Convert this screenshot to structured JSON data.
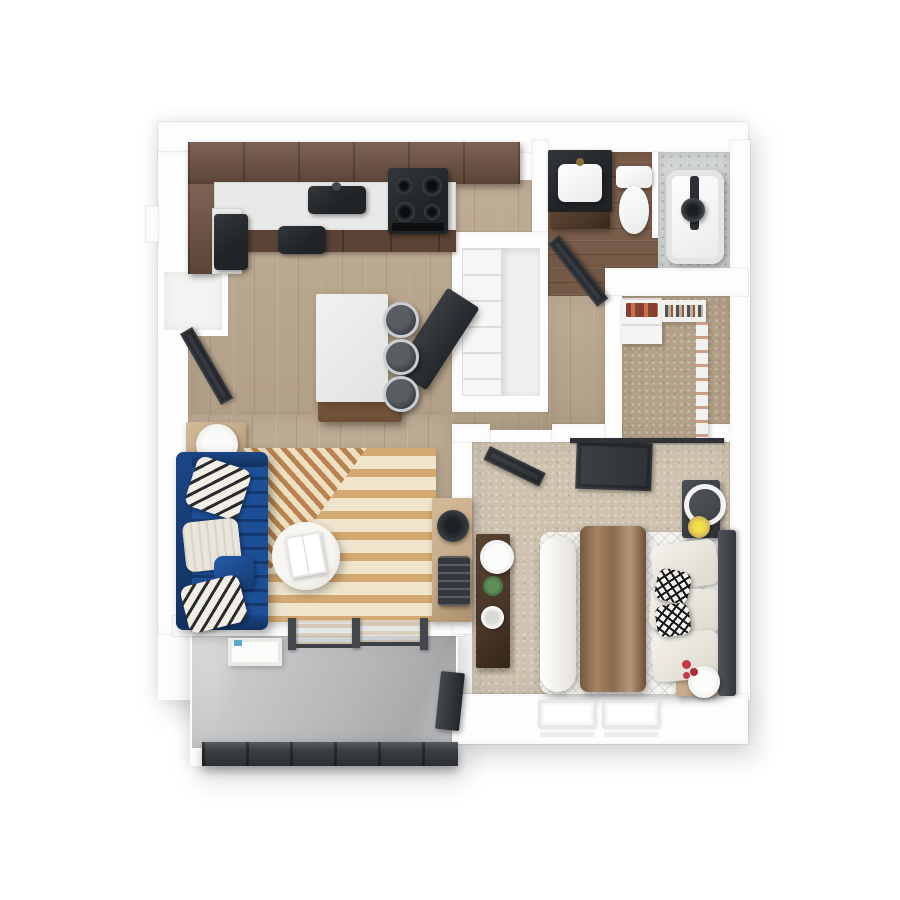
{
  "meta": {
    "title": "3D top-down floor plan render — one-bedroom, one-bath apartment with balcony",
    "view": "top-down 3D dollhouse render",
    "visible_text": ""
  },
  "palette": {
    "wall": "#fdfdfd",
    "wallEdge": "#d9d9d9",
    "woodFloor": "#bca88f",
    "bathFloor": "#7a5d4a",
    "carpet": "#cfc3b0",
    "carpetDark": "#b4a288",
    "concrete": "#b7b9bb",
    "cabinet": "#6f5242",
    "cabinetDark": "#5b4335",
    "counter": "#e9e9e7",
    "black": "#212427",
    "steel": "#c9ced3",
    "navy": "#1d4f96",
    "navyDark": "#143a70",
    "door": "#3c4147",
    "rugBase": "#efe5cd",
    "rugTan": "#d3a871",
    "rugRust": "#b9834d",
    "throwBrown": "#8d7157",
    "bedWhite": "#f4f3ef",
    "woodWarm": "#c5ab8a",
    "walnut": "#4a3628",
    "tile": "#d3d6d4",
    "green": "#3e6b3f",
    "red": "#c43b46",
    "gold": "#d1b05a"
  },
  "rooms": {
    "kitchen": {
      "label": "Kitchen",
      "floor": "hardwood"
    },
    "entry": {
      "label": "Entry",
      "floor": "hardwood"
    },
    "living": {
      "label": "Living Room",
      "floor": "hardwood"
    },
    "bathroom": {
      "label": "Bathroom",
      "floor": "dark hardwood"
    },
    "utility": {
      "label": "Utility Closet",
      "floor": "white"
    },
    "closet": {
      "label": "Walk-in Closet",
      "floor": "carpet"
    },
    "bedroom": {
      "label": "Bedroom",
      "floor": "carpet"
    },
    "balcony": {
      "label": "Balcony",
      "floor": "concrete"
    }
  },
  "furniture": {
    "kitchen": [
      "upper cabinets",
      "counter with sink",
      "range with 4 burners",
      "lower cabinets",
      "refrigerator",
      "tall pantry cabinet",
      "island",
      "3 bar stools"
    ],
    "entry": [
      "coat niche",
      "entry door",
      "side table with lamp"
    ],
    "living": [
      "navy channel-tufted sofa",
      "chevron pillows",
      "knit pillow",
      "striped rug",
      "round coffee table with book",
      "navy accent chair",
      "wood console",
      "fan",
      "slat basket"
    ],
    "bathroom": [
      "vanity with sink",
      "toilet",
      "bathtub with shower",
      "bathroom door"
    ],
    "closet": [
      "shelf unit with clothes",
      "hanging rods"
    ],
    "bedroom": [
      "queen bed",
      "brown throw",
      "white pillows",
      "2 black-white pillows",
      "headboard",
      "barn door",
      "bedroom door",
      "nightstand with round mirror",
      "gold dish",
      "walnut dresser",
      "fan",
      "plant",
      "humidifier",
      "stool with red flowers",
      "2 windows"
    ],
    "balcony": [
      "2 barrel chairs",
      "round wicker table",
      "white console",
      "sliding glass door",
      "wall panel",
      "railing"
    ]
  }
}
